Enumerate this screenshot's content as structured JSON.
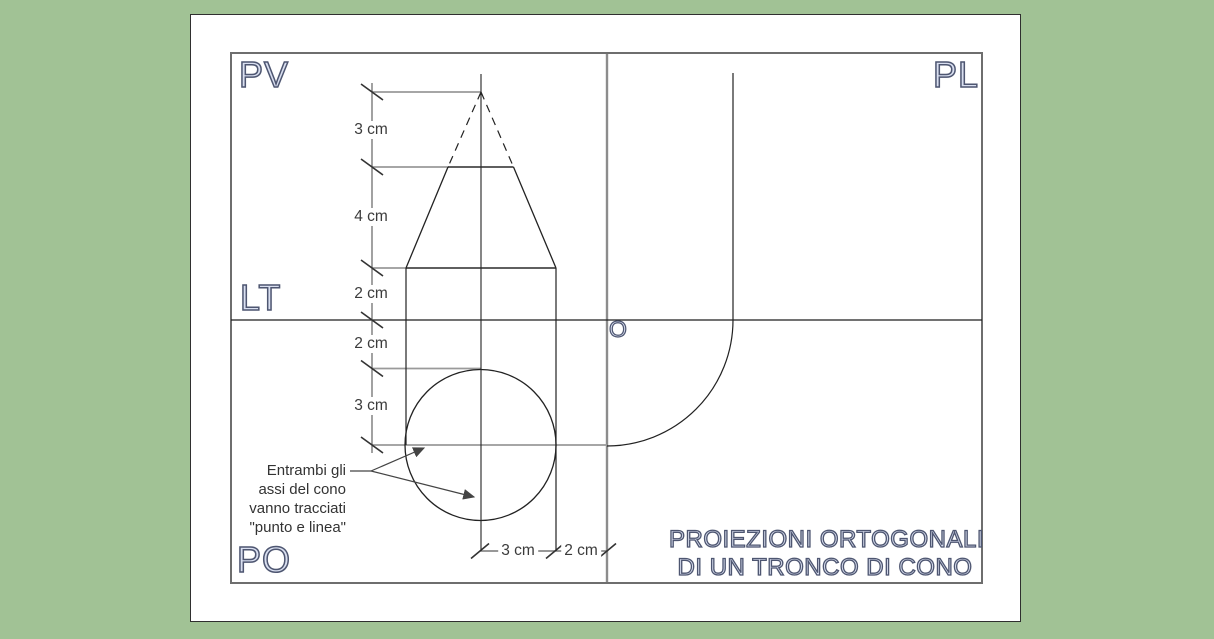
{
  "diagram": {
    "plane_labels": {
      "pv": "PV",
      "pl": "PL",
      "lt": "LT",
      "po": "PO",
      "origin": "O"
    },
    "vertical_dims": [
      "3 cm",
      "4 cm",
      "2 cm",
      "2 cm",
      "3 cm"
    ],
    "horizontal_dims": [
      "3 cm",
      "2 cm"
    ],
    "note_lines": [
      "Entrambi gli",
      "assi del cono",
      "vanno tracciati",
      "\"punto e linea\""
    ],
    "title_lines": [
      "PROIEZIONI ORTOGONALI",
      "DI UN TRONCO DI CONO"
    ],
    "colors": {
      "background": "#a1c295",
      "paper": "#ffffff",
      "drawing_line": "#222222",
      "extension_line": "#9a9a9a",
      "frame_line": "#6e6e6e",
      "label_fill": "#d9dff0",
      "label_outline": "#4e5671"
    }
  }
}
